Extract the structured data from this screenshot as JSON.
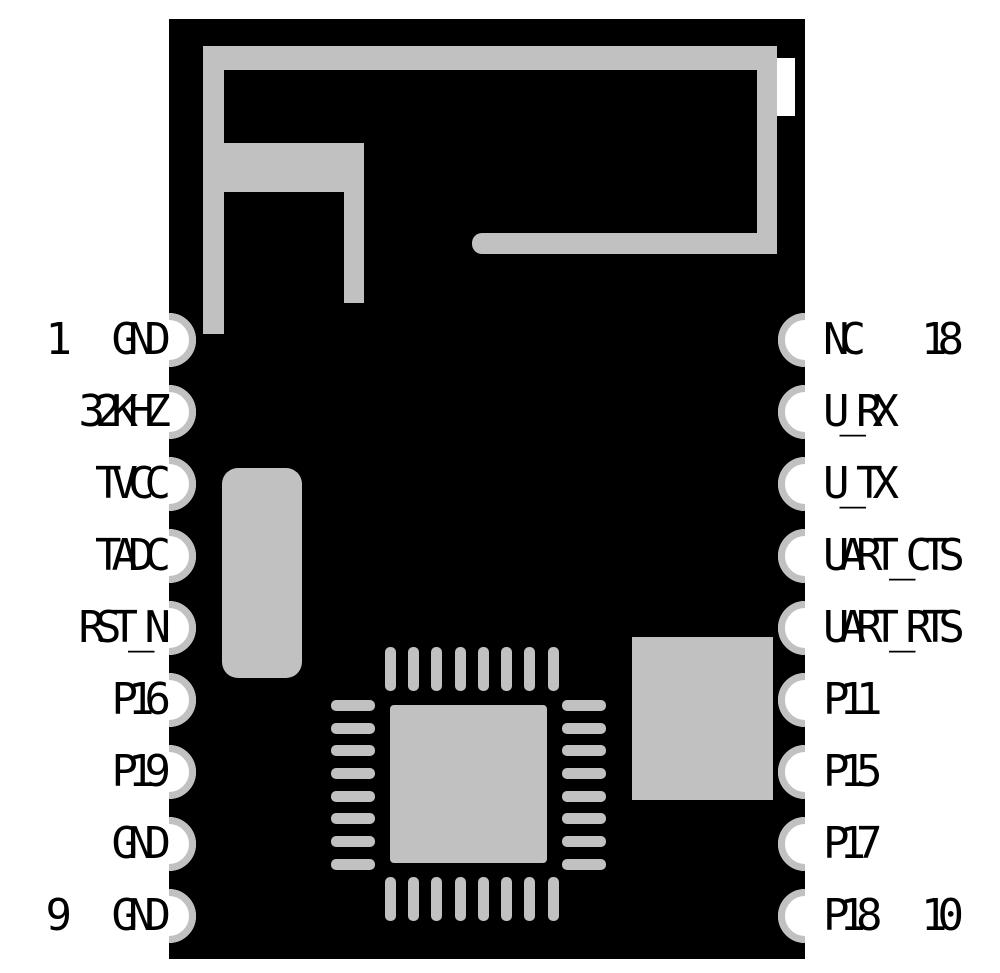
{
  "diagram": {
    "type": "module-pinout",
    "board_color": "#000000",
    "trace_color": "#c1c1c1",
    "background_color": "#ffffff",
    "components": {
      "antenna": "pcb-meander-antenna",
      "soc": "qfn-32-chip",
      "crystal": "crystal-oscillator",
      "flash": "memory-chip"
    }
  },
  "pins": {
    "left": [
      {
        "number": "1",
        "label": "GND"
      },
      {
        "number": "",
        "label": "32KHZ"
      },
      {
        "number": "",
        "label": "TVCC"
      },
      {
        "number": "",
        "label": "TADC"
      },
      {
        "number": "",
        "label": "RST_N"
      },
      {
        "number": "",
        "label": "P16"
      },
      {
        "number": "",
        "label": "P19"
      },
      {
        "number": "",
        "label": "GND"
      },
      {
        "number": "9",
        "label": "GND"
      }
    ],
    "right": [
      {
        "number": "18",
        "label": "NC"
      },
      {
        "number": "",
        "label": "U_RX"
      },
      {
        "number": "",
        "label": "U_TX"
      },
      {
        "number": "",
        "label": "UART_CTS"
      },
      {
        "number": "",
        "label": "UART_RTS"
      },
      {
        "number": "",
        "label": "P11"
      },
      {
        "number": "",
        "label": "P15"
      },
      {
        "number": "",
        "label": "P17"
      },
      {
        "number": "10",
        "label": "P18"
      }
    ]
  }
}
